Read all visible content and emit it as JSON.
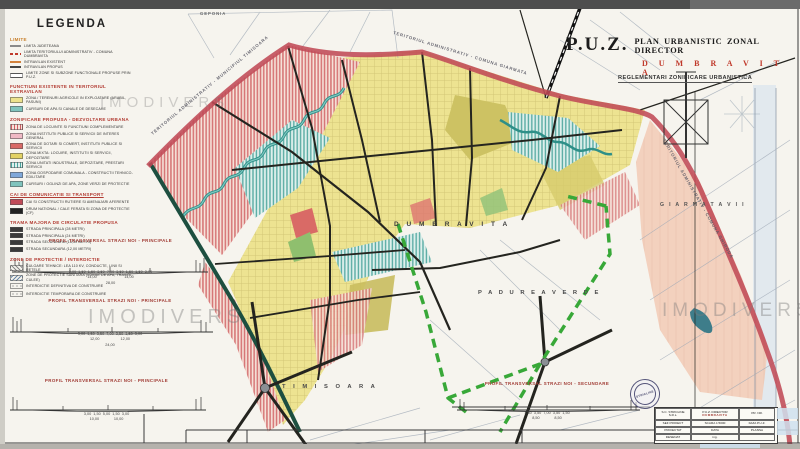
{
  "watermark": "IMODIVERS",
  "title_block": {
    "puz": "P.U.Z.",
    "line": "PLAN URBANISTIC ZONAL DIRECTOR",
    "city": "D U M B R A V I T A",
    "subtitle": "REGLEMENTARI ZONIFICARE URBANISTICA"
  },
  "map_labels": {
    "dumbravita": "D U M B R A V I T A",
    "padurea_verde": "P A D U R E A   V E R D E",
    "timisoara": "T I M I S O A R A",
    "giarmata_vii": "G I A R M A T A   V I I",
    "geponia": "GEPONIA",
    "boundary_top_left": "TERITORIUL ADMINISTRATIV - MUNICIPIUL TIMISOARA",
    "boundary_top_right": "TERITORIUL ADMINISTRATIV - COMUNA GIARMATA",
    "boundary_right": "TERITORIUL ADMINISTRATIV - COMUNA GHIRODA"
  },
  "legend": {
    "title": "LEGENDA",
    "sections": [
      {
        "heading": "LIMITE",
        "heading_color": "#c87f2a",
        "underline": false,
        "items": [
          {
            "swatch": "sw-line-thin",
            "label": "LIMITA JUDETEANA"
          },
          {
            "swatch": "sw-line-reddash",
            "label": "LIMITA TERITORIULUI ADMINISTRATIV - COMUNA DUMBRAVITA"
          },
          {
            "swatch": "sw-line-orange",
            "label": "INTRAVILAN EXISTENT"
          },
          {
            "swatch": "sw-line-dark",
            "label": "INTRAVILAN PROPUS"
          },
          {
            "swatch": "sw-line-double",
            "label": "LIMITE ZONE SI SUBZONE FUNCTIONALE PROPUSE PRIN P.U.Z."
          }
        ]
      },
      {
        "heading": "FUNCTIUNI EXISTENTE IN TERITORIUL EXTRAVILAN",
        "heading_color": "#b23b32",
        "underline": false,
        "items": [
          {
            "swatch": "sw-yellow",
            "label": "ZONA / TERENURI AGRICOLE IN EXPLOATARE (ARABIL, PASUNI)"
          },
          {
            "swatch": "sw-water",
            "label": "CURSURI DE APA SI CANALE DE DESECARE"
          }
        ]
      },
      {
        "heading": "ZONIFICARE PROPUSA - DEZVOLTARE URBANA",
        "heading_color": "#b23b32",
        "underline": false,
        "items": [
          {
            "swatch": "sw-pinkhatch",
            "label": "ZONA DE LOCUINTE SI FUNCTIUNI COMPLEMENTARE"
          },
          {
            "swatch": "sw-pink",
            "label": "ZONA INSTITUTII PUBLICE SI SERVICII DE INTERES GENERAL"
          },
          {
            "swatch": "sw-red",
            "label": "ZONA DE DOTARI SI COMERT, INSTITUTII PUBLICE SI SERVICII"
          },
          {
            "swatch": "sw-yellow2",
            "label": "ZONA MIXTA: LOCUIRE, INSTITUTII SI SERVICII, DEPOZITARE"
          },
          {
            "swatch": "sw-teal",
            "label": "ZONA UNITATI INDUSTRIALE, DEPOZITARE, PRESTARI SERVICII"
          },
          {
            "swatch": "sw-blue",
            "label": "ZONA GOSPODARIE COMUNALA - CONSTRUCTII TEHNICO-EDILITARE"
          },
          {
            "swatch": "sw-water",
            "label": "CURSURI / OGLINZI DE APA, ZONE VERZI DE PROTECTIE"
          }
        ]
      },
      {
        "heading": "CAI DE COMUNICATIE SI TRANSPORT",
        "heading_color": "#b23b32",
        "underline": true,
        "items": [
          {
            "swatch": "sw-roadred",
            "label": "CAI SI CONSTRUCTII RUTIERE SI AMENAJARI AFERENTE"
          },
          {
            "swatch": "sw-black",
            "label": "DRUM NATIONAL / CALE FERATA SI ZONA DE PROTECTIE (CF)"
          }
        ]
      },
      {
        "heading": "TRAMA MAJORA DE CIRCULATIE PROPUSA",
        "heading_color": "#b23b32",
        "underline": false,
        "items": [
          {
            "swatch": "sw-dark",
            "label": "STRADA PRINCIPALA (28 METRI)"
          },
          {
            "swatch": "sw-dark",
            "label": "STRADA PRINCIPALA (24 METRI)"
          },
          {
            "swatch": "sw-dark",
            "label": "STRADA SECUNDARA (16,50 METRI)"
          },
          {
            "swatch": "sw-dark",
            "label": "STRADA SECUNDARA (12,00 METRI)"
          }
        ]
      },
      {
        "heading": "ZONE DE PROTECTIE / INTERDICTIE",
        "heading_color": "#b23b32",
        "underline": false,
        "items": [
          {
            "swatch": "sw-hatchdiag",
            "label": "CULOARE TEHNICE: LEA 110 KV, CONDUCTE, LINII SI RETELE"
          },
          {
            "swatch": "sw-hatchdiag2",
            "label": "ZONE DE PROTECTIE SANITARA (SURSE DE APA, TRASEE, CULEE)"
          },
          {
            "swatch": "sw-circles",
            "label": "INTERDICTIE DEFINITIVA DE CONSTRUIRE"
          },
          {
            "swatch": "sw-circles",
            "label": "INTERDICTIE TEMPORARA DE CONSTRUIRE"
          }
        ]
      }
    ]
  },
  "profiles": [
    {
      "title": "PROFIL TRANSVERSAL STRAZI NOI - PRINCIPALE",
      "dims": "3,00  1,50  1,50  3,50  7,00  3,50  1,50  1,50  3,00",
      "totals": "14,00                          14,00",
      "grand": "28,00"
    },
    {
      "title": "PROFIL TRANSVERSAL STRAZI NOI - PRINCIPALE",
      "dims": "3,00  1,50  3,50  7,00  3,50  1,50  3,00",
      "totals": "12,00                    12,00",
      "grand": "24,00"
    },
    {
      "title": "PROFIL TRANSVERSAL STRAZI NOI - PRINCIPALE",
      "dims": "3,00  1,50  5,00  1,50  3,00",
      "totals": "10,00              10,00",
      "grand": "20,00"
    },
    {
      "title": "PROFIL TRANSVERSAL STRAZI NOI - SECUNDARE",
      "dims": "1,50  3,50  7,00  3,50  1,50",
      "totals": "8,50              8,50",
      "grand": "17,00"
    }
  ],
  "cartouche": {
    "firm": "S.C. STRICLINE S.R.L.",
    "title1": "P.U.Z. DIRECTOR",
    "title2": "DUMBRAVITA",
    "prnr": "PR. NR.",
    "rows": [
      {
        "role": "SEF PROIECT",
        "name": "arh."
      },
      {
        "role": "PROIECTAT",
        "name": "arh."
      },
      {
        "role": "DESENAT",
        "name": "ing."
      }
    ],
    "scara": "SCARA 1:5000",
    "data_label": "DATA",
    "faza": "FAZA P.U.Z.",
    "plansa": "PLANSA"
  },
  "stamp_text": "STRICLINE",
  "colors": {
    "paper": "#f6f4ee",
    "title_red": "#c0392b",
    "crimson_boundary": "#c04a57",
    "green_boundary": "#38a838",
    "road_black": "#24241f",
    "ring_road": "#1d4f40",
    "river_teal": "#2e8f88",
    "zone_yellow": "#ece28c",
    "zone_red_hatch": "#cf5f63",
    "zone_teal_hatch": "#4aa39c",
    "zone_salmon": "#f3cdb9",
    "watermark_gray": "#7d7d7d"
  }
}
